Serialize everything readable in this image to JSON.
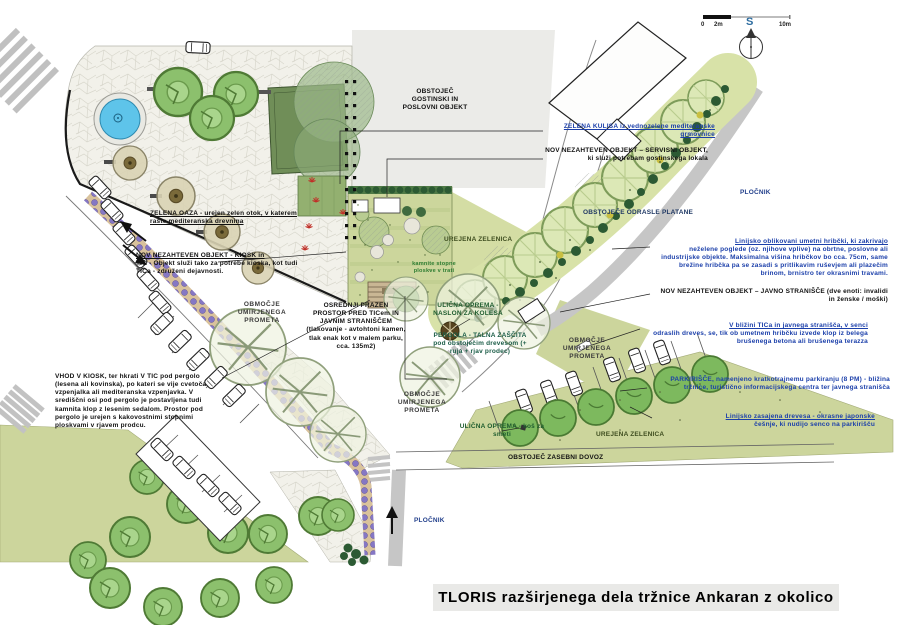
{
  "title": "TLORIS razširjenega dela tržnice Ankaran z okolico",
  "scalebar": {
    "start": "0",
    "mid": "2m",
    "end": "10m"
  },
  "north_label": "S",
  "annotations": {
    "obstojec_gostinski": "OBSTOJEČ GOSTINSKI IN POSLOVNI OBJEKT",
    "zelena_kulisa": "ZELENA KULISA iz vednozelene mediteranske grmovnice",
    "servisni_objekt": "NOV NEZAHTEVEN OBJEKT – SERVISNI OBJEKT, ki služi potrebam gostinskega lokala",
    "plocnik": "PLOČNIK",
    "odrasle_platane": "OBSTOJEČE ODRASLE PLATANE",
    "hribcki_head": "Linijsko oblikovani umetni hribčki, ki zakrivajo",
    "hribcki_body": "neželene poglede (oz. njihove vplive) na obrtne, poslovne ali industrijske objekte. Maksimalna višina hribčkov bo cca. 75cm, same brežine hribčka pa se zasadi s pritlikavim ruševjem ali plazečim brinom, brnistro ter okrasnimi travami.",
    "javno_stranisce": "NOV NEZAHTEVEN OBJEKT – JAVNO STRANIŠČE (dve enoti: invalidi in ženske / moški)",
    "klop_head": "V bližini TICa in javnega stranišča, v senci",
    "klop_body": "odraslih dreves, se, tik ob umetnem hribčku izvede klop iz belega brušenega betona ali brušenega terazza",
    "parkirisce": "PARKIRIŠČE, namenjeno kratkotrajnemu parkiranju (8 PM) - bližina tržnice, turistično informacijskega centra ter javnega stranišča",
    "cesnje_head": "Linijsko zasajena drevesa - okrasne japonske",
    "cesnje_body": "češnje, ki nudijo senco na parkirišču",
    "urejena_zelenica": "UREJENA ZELENICA",
    "zasebni_dovoz": "OBSTOJEČ ZASEBNI DOVOZ",
    "zelena_oaza": "ZELENA OAZA - urejen zelen otok, v katerem raste mediteranska drevnina",
    "kiosk_head": "NOV NEZAHTEVEN OBJEKT - KIOSK in",
    "kiosk_body": "TIC - Objekt služi tako za potrebe kioska, kot tudi TICa - združeni dejavnosti.",
    "obmocje_umirjenega": "OBMOČJE UMIRJENEGA PROMETA",
    "osrednji": "OSREDNJI PRAZEN PROSTOR PRED TICem IN JAVNIM STRANIŠČEM (tlakovanje - avtohtoni kamen, tlak enak kot v malem parku, cca. 135m2)",
    "naslon": "ULIČNA OPREMA - NASLON ZA KOLESA",
    "pergola": "PERGOLA - TALNA ZAŠČITA pod obstoječim drevesom (+ ruja + rjav prodec)",
    "kos": "ULIČNA OPREMA - koš za smeti",
    "vhod": "VHOD V KIOSK, ter hkrati V TIC pod pergolo (lesena ali kovinska), po kateri se vije cvetoča vzpenjalka ali mediteranska vzpenjavka. V središčni osi pod pergolo je postavljena tudi kamnita klop z lesenim sedalom. Prostor pod pergolo je urejen s kakovostnimi stopnimi ploskvami v rjavem prodcu.",
    "stopne": "kamnite stopne ploskve v trati"
  },
  "colors": {
    "annotation_blue": "#1b3faa",
    "lawn_olive": "#ccd59c",
    "mound_sage": "#d8e2a8",
    "water_blue": "#5ec4ea",
    "tree_green": "#8cc06d",
    "road_gray": "#c9c9c9",
    "flower_purple": "#8577c4"
  }
}
